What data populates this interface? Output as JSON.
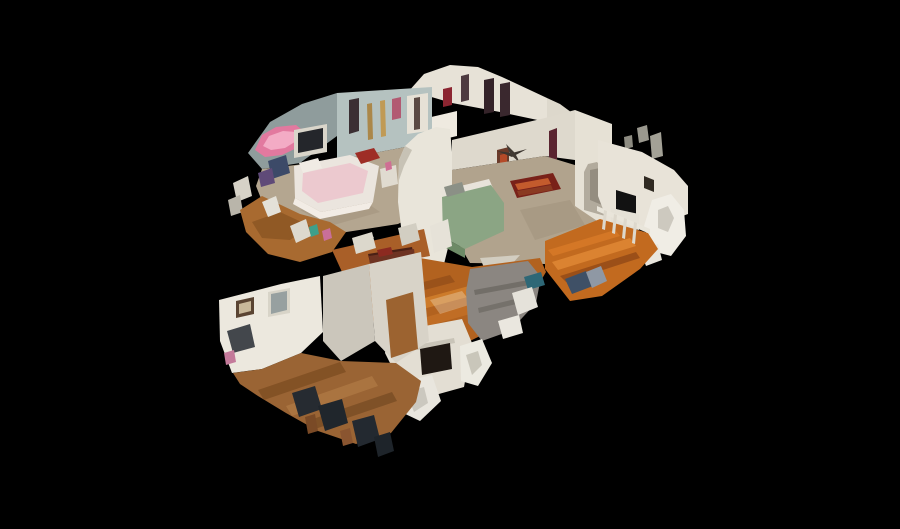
{
  "scene": {
    "label": "3D dollhouse cutaway view of a two-story home interior",
    "background": "#000000",
    "canvas": {
      "width": 900,
      "height": 529
    },
    "colors": {
      "background": "#000000",
      "wall_white": "#e8e3d8",
      "wall_bluegray": "#b5c2c0",
      "attic_gray": "#8f9c9c",
      "carpet_tan": "#b4a690",
      "hardwood_living": "#b2621f",
      "hardwood_dining": "#c26a1f",
      "hardwood_room": "#9a6434",
      "bed_green": "#8ba584",
      "canopy_pink": "#e2799f",
      "rug_red": "#792119",
      "sofa_gray": "#8b8681",
      "piano_brown": "#6e3322"
    },
    "polygons": [
      {
        "name": "fragment-gray-1",
        "points": "637,128 647,125 649,140 639,143",
        "fill": "#9a988e"
      },
      {
        "name": "fragment-gray-2",
        "points": "650,136 661,132 663,156 652,159",
        "fill": "#a3a196"
      },
      {
        "name": "fragment-gray-3",
        "points": "624,137 632,135 633,147 625,149",
        "fill": "#8e8c82"
      },
      {
        "name": "fragment-white-top",
        "points": "600,128 609,125 611,141 602,144",
        "fill": "#d8d4c9"
      },
      {
        "name": "gable-wall",
        "points": "408,92 424,74 450,65 478,67 502,77 547,98 547,122 500,112 452,103 428,96",
        "fill": "#e7e2d7"
      },
      {
        "name": "gable-right-slope",
        "points": "547,98 560,104 598,132 598,150 575,141 547,122",
        "fill": "#ddd8cc"
      },
      {
        "name": "gable-window-1",
        "points": "484,80 494,78 494,112 484,114",
        "fill": "#342329"
      },
      {
        "name": "gable-window-2",
        "points": "500,84 510,82 510,115 500,117",
        "fill": "#3a282e"
      },
      {
        "name": "gable-art-red",
        "points": "443,89 452,87 452,105 443,107",
        "fill": "#8c2531"
      },
      {
        "name": "gable-door-dark",
        "points": "461,76 469,74 469,100 461,102",
        "fill": "#4d3a40"
      },
      {
        "name": "vanity-white",
        "points": "427,118 457,111 457,136 427,143",
        "fill": "#efeae0"
      },
      {
        "name": "attic-sloped-wall",
        "points": "248,153 270,122 302,104 337,93 337,136 300,163 262,169",
        "fill": "#8f9c9c"
      },
      {
        "name": "canopy-pink",
        "points": "255,150 262,135 276,127 296,125 306,133 301,146 282,155 265,157",
        "fill": "#e2799f"
      },
      {
        "name": "canopy-pink-light",
        "points": "263,146 269,136 283,131 296,132 298,140 285,148 271,150",
        "fill": "#f3abc5"
      },
      {
        "name": "bedroom1-back-wall",
        "points": "337,93 432,87 432,142 337,160",
        "fill": "#b5c2c0"
      },
      {
        "name": "bedroom1-door-dark",
        "points": "349,100 359,98 359,131 349,134",
        "fill": "#3b2f33"
      },
      {
        "name": "bedroom1-gold-decor-1",
        "points": "367,104 372,103 373,139 368,140",
        "fill": "#ab8749"
      },
      {
        "name": "bedroom1-gold-decor-2",
        "points": "380,101 385,100 386,136 381,137",
        "fill": "#c09a55"
      },
      {
        "name": "bedroom1-art-pink",
        "points": "392,99 401,97 401,118 392,120",
        "fill": "#b25a72"
      },
      {
        "name": "bedroom1-wardrobe",
        "points": "407,96 428,93 428,131 407,134",
        "fill": "#e6e1d6"
      },
      {
        "name": "bedroom1-wardrobe-gap",
        "points": "414,98 420,97 420,129 414,130",
        "fill": "#5b4a44"
      },
      {
        "name": "bedroom1-carpet",
        "points": "262,169 337,160 432,142 452,160 450,198 398,224 340,233 294,229 264,206 256,186",
        "fill": "#b4a690"
      },
      {
        "name": "bedroom1-carpet-shade",
        "points": "300,210 360,198 380,212 330,226",
        "fill": "#a4957e",
        "opacity": 0.6
      },
      {
        "name": "tv-frame",
        "points": "294,130 327,124 327,152 294,158",
        "fill": "#d9d5ca"
      },
      {
        "name": "tv-screen",
        "points": "298,133 323,128 323,148 298,153",
        "fill": "#24262b"
      },
      {
        "name": "bed1-white",
        "points": "294,166 350,155 379,166 373,202 321,212 295,198",
        "fill": "#ebe5de"
      },
      {
        "name": "bed1-pink-blanket",
        "points": "303,173 350,163 368,171 363,193 318,203 302,191",
        "fill": "#ecc9cf"
      },
      {
        "name": "bed1-ruffle",
        "points": "295,198 321,212 373,202 369,209 320,219 293,204",
        "fill": "#f2ece5"
      },
      {
        "name": "bed1-red-pillow",
        "points": "355,153 374,148 380,158 361,164",
        "fill": "#9e2d26"
      },
      {
        "name": "bed1-white-pillow",
        "points": "299,163 318,158 322,168 303,173",
        "fill": "#f0ebe4"
      },
      {
        "name": "clothes-pile-blue",
        "points": "268,161 286,155 290,173 272,179",
        "fill": "#3c4a68"
      },
      {
        "name": "clothes-pile-purple",
        "points": "258,173 272,168 275,183 261,187",
        "fill": "#5f4a78"
      },
      {
        "name": "nightstand",
        "points": "380,169 396,165 398,184 382,188",
        "fill": "#e0dbd0"
      },
      {
        "name": "nightstand-pink-item",
        "points": "385,163 391,161 392,169 386,171",
        "fill": "#cf6f94"
      },
      {
        "name": "left-edge-fragment-1",
        "points": "233,183 248,176 252,196 237,202",
        "fill": "#d6d2c7"
      },
      {
        "name": "left-edge-fragment-2",
        "points": "228,200 240,195 243,212 231,216",
        "fill": "#b9b5aa"
      },
      {
        "name": "hallway-wood",
        "points": "240,210 262,196 300,214 330,222 346,232 332,252 300,262 268,254 246,232",
        "fill": "#a86a30"
      },
      {
        "name": "hallway-wood-shade",
        "points": "252,222 280,212 310,226 290,240 262,238",
        "fill": "#7c4a1e",
        "opacity": 0.55
      },
      {
        "name": "hallway-fragment-1",
        "points": "262,202 276,196 281,212 268,217",
        "fill": "#e4e1d8"
      },
      {
        "name": "hallway-fragment-2",
        "points": "290,226 306,219 311,236 296,243",
        "fill": "#ddd9ce"
      },
      {
        "name": "hallway-item-teal",
        "points": "309,227 317,224 319,234 311,237",
        "fill": "#3e9f8a"
      },
      {
        "name": "hallway-item-pink",
        "points": "322,231 330,228 332,238 324,241",
        "fill": "#c96f9a"
      },
      {
        "name": "stairwell-wall-curved",
        "points": "399,160 405,146 418,134 436,127 450,129 452,152 452,232 444,264 420,269 404,251 398,202",
        "fill": "#e9e5da"
      },
      {
        "name": "stairwell-wall-edge",
        "points": "399,160 405,146 412,150 404,166 399,180",
        "fill": "#c7c2b5"
      },
      {
        "name": "mesh-beam-gray",
        "points": "331,317 339,319 374,237 366,234",
        "fill": "#a8a59c"
      },
      {
        "name": "master-back-wall",
        "points": "452,140 545,118 575,110 575,160 545,156 452,170",
        "fill": "#ded9cd"
      },
      {
        "name": "master-curtain-maroon",
        "points": "549,131 557,128 557,172 549,175",
        "fill": "#5a2430"
      },
      {
        "name": "master-door",
        "points": "497,150 509,147 509,185 497,188",
        "fill": "#6b3b2a"
      },
      {
        "name": "master-door-red-coat",
        "points": "500,155 507,153 507,171 500,173",
        "fill": "#b44a28"
      },
      {
        "name": "ceiling-fan-blade-1",
        "points": "497,151 512,153 527,149 512,157",
        "fill": "#3c3630"
      },
      {
        "name": "ceiling-fan-blade-2",
        "points": "506,144 515,153 520,163 510,154",
        "fill": "#423b34"
      },
      {
        "name": "master-carpet",
        "points": "452,170 545,156 598,172 598,238 545,264 470,263 452,232",
        "fill": "#b1a38d"
      },
      {
        "name": "master-carpet-shade",
        "points": "520,210 570,200 585,225 535,240",
        "fill": "#a0927c",
        "opacity": 0.5
      },
      {
        "name": "oriental-rug",
        "points": "510,181 553,173 561,189 517,198",
        "fill": "#792119"
      },
      {
        "name": "oriental-rug-stripe-1",
        "points": "515,184 548,178 551,184 518,190",
        "fill": "#c35b2d"
      },
      {
        "name": "oriental-rug-stripe-2",
        "points": "517,191 551,185 553,190 519,196",
        "fill": "#8a3a22"
      },
      {
        "name": "bed2-mattress-edge",
        "points": "440,191 489,179 493,188 445,200",
        "fill": "#e8e3da"
      },
      {
        "name": "bed2-green-cover",
        "points": "442,197 491,185 504,203 504,231 465,249 443,237",
        "fill": "#8ba584"
      },
      {
        "name": "bed2-green-foot",
        "points": "443,237 465,249 465,258 446,248",
        "fill": "#6d8a66"
      },
      {
        "name": "bed2-pillow",
        "points": "444,187 462,182 465,192 447,197",
        "fill": "#8b9086"
      },
      {
        "name": "bed2-mesh-tear",
        "points": "430,226 448,219 452,246 434,253",
        "fill": "#e6e2d8"
      },
      {
        "name": "master-edge-fragment",
        "points": "480,258 520,255 505,272 485,270",
        "fill": "#d2cdc0"
      },
      {
        "name": "arch-wall",
        "points": "575,110 612,124 612,231 575,206",
        "fill": "#e6e1d5"
      },
      {
        "name": "arch-opening",
        "points": "584,172 588,164 597,162 603,169 605,177 605,216 584,210",
        "fill": "#b2ab9d"
      },
      {
        "name": "arch-inner-shadow",
        "points": "590,170 600,168 602,176 602,205 590,200",
        "fill": "#948d80"
      },
      {
        "name": "landing-wall",
        "points": "598,140 642,152 674,170 688,186 688,214 655,226 612,233 598,196",
        "fill": "#e8e3d8"
      },
      {
        "name": "landing-tv",
        "points": "616,190 636,196 636,215 616,209",
        "fill": "#121212"
      },
      {
        "name": "landing-cabinet",
        "points": "611,208 639,214 639,230 611,224",
        "fill": "#e5e1d6"
      },
      {
        "name": "landing-art",
        "points": "644,176 654,180 654,192 644,188",
        "fill": "#302a22"
      },
      {
        "name": "cut-wall-curl-1",
        "points": "652,200 671,194 684,210 686,236 671,256 652,251 644,226",
        "fill": "#f0ede5"
      },
      {
        "name": "cut-wall-curl-shade",
        "points": "658,210 668,206 674,218 668,232 658,228",
        "fill": "#b6b1a5",
        "opacity": 0.6
      },
      {
        "name": "cut-wall-curl-2",
        "points": "640,250 658,244 662,260 646,266",
        "fill": "#e9e6dd"
      },
      {
        "name": "dining-floor",
        "points": "545,241 600,219 648,233 658,249 640,269 602,296 570,301 545,269",
        "fill": "#c26a1f"
      },
      {
        "name": "dining-plank-1",
        "points": "552,262 630,238 636,246 558,270",
        "fill": "#e18a36",
        "opacity": 0.8
      },
      {
        "name": "dining-plank-2",
        "points": "560,276 636,252 640,258 566,282",
        "fill": "#8a4516",
        "opacity": 0.7
      },
      {
        "name": "dining-plank-3",
        "points": "548,250 615,230 620,236 553,256",
        "fill": "#d97c2a",
        "opacity": 0.75
      },
      {
        "name": "stair-handrail",
        "points": "597,206 650,229 650,234 597,211",
        "fill": "#e9e5da"
      },
      {
        "name": "stair-spindle-1",
        "points": "604,210 607,211 605,230 602,229",
        "fill": "#ddd8cc"
      },
      {
        "name": "stair-spindle-2",
        "points": "614,214 617,215 615,234 612,233",
        "fill": "#ddd8cc"
      },
      {
        "name": "stair-spindle-3",
        "points": "624,218 627,219 625,239 622,238",
        "fill": "#ddd8cc"
      },
      {
        "name": "stair-spindle-4",
        "points": "634,222 637,223 635,244 632,243",
        "fill": "#ddd8cc"
      },
      {
        "name": "floor-bags-blue",
        "points": "565,279 586,271 593,286 572,294",
        "fill": "#3f5066"
      },
      {
        "name": "floor-bags-gray",
        "points": "586,272 601,266 607,281 592,288",
        "fill": "#8f98a4"
      },
      {
        "name": "living-floor",
        "points": "352,283 372,252 420,258 472,267 540,258 546,272 520,316 470,341 420,347 383,331 358,306",
        "fill": "#b2621f"
      },
      {
        "name": "living-plank-1",
        "points": "380,310 480,283 486,292 386,319",
        "fill": "#d8862f",
        "opacity": 0.7
      },
      {
        "name": "living-plank-2",
        "points": "370,296 450,275 455,282 375,303",
        "fill": "#8a4718",
        "opacity": 0.6
      },
      {
        "name": "living-plank-3",
        "points": "395,326 500,296 505,304 400,334",
        "fill": "#c9742a",
        "opacity": 0.6
      },
      {
        "name": "living-floor-highlight",
        "points": "430,300 462,291 472,304 440,314",
        "fill": "#f2e2c8",
        "opacity": 0.35
      },
      {
        "name": "upper-hall-wood",
        "points": "332,250 424,229 430,256 342,272",
        "fill": "#a95f28"
      },
      {
        "name": "upper-hall-fragment-1",
        "points": "352,238 372,232 376,248 356,254",
        "fill": "#dcd8cc"
      },
      {
        "name": "upper-hall-fragment-2",
        "points": "398,228 416,223 420,240 402,246",
        "fill": "#d2cec2"
      },
      {
        "name": "piano-lid",
        "points": "368,254 412,247 414,256 370,263",
        "fill": "#4a2015"
      },
      {
        "name": "piano-body",
        "points": "369,256 414,249 419,291 374,298",
        "fill": "#6e3322"
      },
      {
        "name": "piano-keys",
        "points": "374,273 416,266 417,274 375,281",
        "fill": "#eae4d8"
      },
      {
        "name": "piano-red-cloth",
        "points": "377,250 391,247 393,254 379,257",
        "fill": "#8c2a20"
      },
      {
        "name": "sofa-sectional",
        "points": "470,269 528,261 541,277 536,303 510,331 482,341 468,323 466,291",
        "fill": "#8b8681"
      },
      {
        "name": "sofa-seam-1",
        "points": "474,290 534,279 535,284 475,295",
        "fill": "#6c6862",
        "opacity": 0.8
      },
      {
        "name": "sofa-seam-2",
        "points": "478,308 528,296 529,301 479,313",
        "fill": "#6c6862",
        "opacity": 0.7
      },
      {
        "name": "sofa-teal-item",
        "points": "524,277 541,272 545,285 528,290",
        "fill": "#2e6776"
      },
      {
        "name": "sofa-mesh-tear-1",
        "points": "512,293 532,287 538,307 518,315",
        "fill": "#e5e2da"
      },
      {
        "name": "sofa-mesh-tear-2",
        "points": "498,321 519,315 523,333 503,339",
        "fill": "#eae7df"
      },
      {
        "name": "fireplace-wall",
        "points": "388,333 462,319 472,343 464,387 428,397 398,379 385,353",
        "fill": "#e3ded3"
      },
      {
        "name": "fireplace-mantel",
        "points": "416,345 454,338 455,343 417,350",
        "fill": "#c9c4b8"
      },
      {
        "name": "fireplace-box",
        "points": "420,349 450,343 452,369 422,375",
        "fill": "#1f1813"
      },
      {
        "name": "fireplace-mesh-tear",
        "points": "460,346 482,339 492,363 478,386 461,381",
        "fill": "#eceae1"
      },
      {
        "name": "fireplace-mesh-shade",
        "points": "466,355 478,351 482,365 472,375",
        "fill": "#b2ada0",
        "opacity": 0.6
      },
      {
        "name": "ghost-chair-white",
        "points": "398,383 432,375 441,401 420,421 399,411",
        "fill": "#e9e6de"
      },
      {
        "name": "ghost-chair-shade",
        "points": "406,392 424,387 428,403 414,412",
        "fill": "#b8b4aa",
        "opacity": 0.6
      },
      {
        "name": "frontroom-left-wall",
        "points": "219,300 281,284 320,276 323,332 301,353 262,369 232,373 220,341",
        "fill": "#ece8de"
      },
      {
        "name": "frontroom-wall-2",
        "points": "323,276 369,264 375,341 341,361 323,341",
        "fill": "#cbc6bb"
      },
      {
        "name": "frontroom-wall-3",
        "points": "369,264 421,252 429,341 396,363 375,341",
        "fill": "#d8d3c8"
      },
      {
        "name": "frontroom-doorway",
        "points": "386,300 413,292 418,349 391,358",
        "fill": "#9c6330"
      },
      {
        "name": "frontroom-art-frame",
        "points": "236,301 254,297 254,314 236,318",
        "fill": "#5a4432"
      },
      {
        "name": "frontroom-art-inner",
        "points": "239,304 251,301 251,311 239,314",
        "fill": "#c8b89a"
      },
      {
        "name": "frontroom-window-frame",
        "points": "268,292 290,288 290,313 268,317",
        "fill": "#d8d4c8"
      },
      {
        "name": "frontroom-window-glass",
        "points": "271,294 287,291 287,310 271,314",
        "fill": "#97a0a0"
      },
      {
        "name": "frontroom-desk-dark",
        "points": "227,331 250,324 255,347 233,353",
        "fill": "#43474c"
      },
      {
        "name": "frontroom-pink-item",
        "points": "224,353 234,350 236,362 226,365",
        "fill": "#c47a9a"
      },
      {
        "name": "frontroom-floor",
        "points": "233,373 262,369 301,353 341,361 396,363 421,381 416,402 391,433 356,444 318,431 286,413 258,396 240,384",
        "fill": "#9a6434"
      },
      {
        "name": "frontroom-plank-1",
        "points": "258,390 340,362 346,372 264,400",
        "fill": "#74461d",
        "opacity": 0.6
      },
      {
        "name": "frontroom-plank-2",
        "points": "286,406 372,376 378,386 292,416",
        "fill": "#b8824a",
        "opacity": 0.55
      },
      {
        "name": "frontroom-plank-3",
        "points": "310,420 392,392 397,401 315,429",
        "fill": "#6e441f",
        "opacity": 0.6
      },
      {
        "name": "dark-chair-1",
        "points": "292,393 315,386 322,409 299,417",
        "fill": "#262b31"
      },
      {
        "name": "dark-chair-2",
        "points": "318,406 342,399 348,423 325,431",
        "fill": "#20262c"
      },
      {
        "name": "dark-chair-3",
        "points": "352,421 374,415 380,439 358,447",
        "fill": "#232930"
      },
      {
        "name": "dark-chair-4",
        "points": "374,437 390,432 394,451 378,457",
        "fill": "#1e242a"
      },
      {
        "name": "chair-leg-wood-1",
        "points": "305,417 315,414 318,431 308,434",
        "fill": "#7a4a26"
      },
      {
        "name": "chair-leg-wood-2",
        "points": "340,431 350,428 353,443 343,446",
        "fill": "#8a5530"
      }
    ]
  }
}
